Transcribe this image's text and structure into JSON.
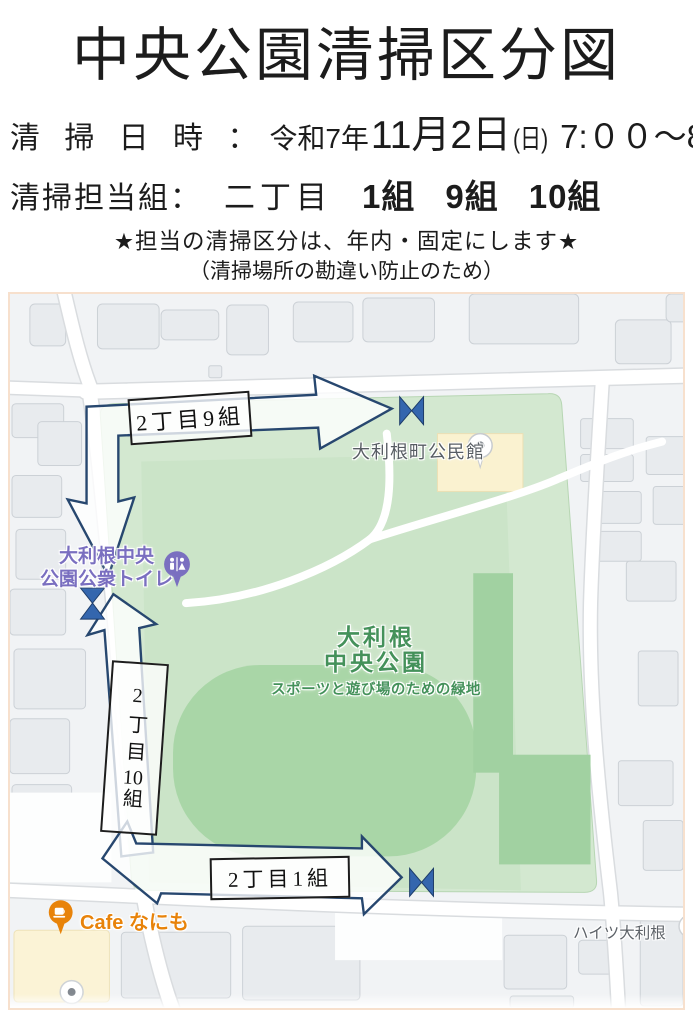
{
  "header": {
    "title": "中央公園清掃区分図",
    "date_label": "清 掃 日 時 ：",
    "date_era": "令和7年",
    "date_value": "11月2日",
    "date_week": "(日)",
    "date_time": "7:００～8:00",
    "duty_label": "清掃担当組：",
    "duty_area": "二丁目",
    "groups": [
      "1組",
      "9組",
      "10組"
    ],
    "note_star": "★担当の清掃区分は、年内・固定にします★",
    "note_paren": "（清掃場所の勘違い防止のため）"
  },
  "map": {
    "zones": {
      "zone9": "2丁目9組",
      "zone1": "2丁目1組",
      "zone10_a": "2丁目",
      "zone10_b": "10",
      "zone10_c": "組"
    },
    "poi": {
      "community_hall": "大利根町公民館",
      "toilet_line1": "大利根中央",
      "toilet_line2": "公園公衆トイレ",
      "park_line1": "大利根",
      "park_line2": "中央公園",
      "park_subtitle": "スポーツと遊び場のための緑地",
      "cafe": "Cafe なにも",
      "heights": "ハイツ大利根"
    },
    "colors": {
      "arrow_navy": "#27476f",
      "bowtie_blue": "#3466ae",
      "park_green": "#d3e8d0",
      "field_green": "#a9d6a7",
      "poi_purple": "#7a6fc0",
      "poi_orange": "#e8830a",
      "park_label_green": "#44915a"
    }
  }
}
